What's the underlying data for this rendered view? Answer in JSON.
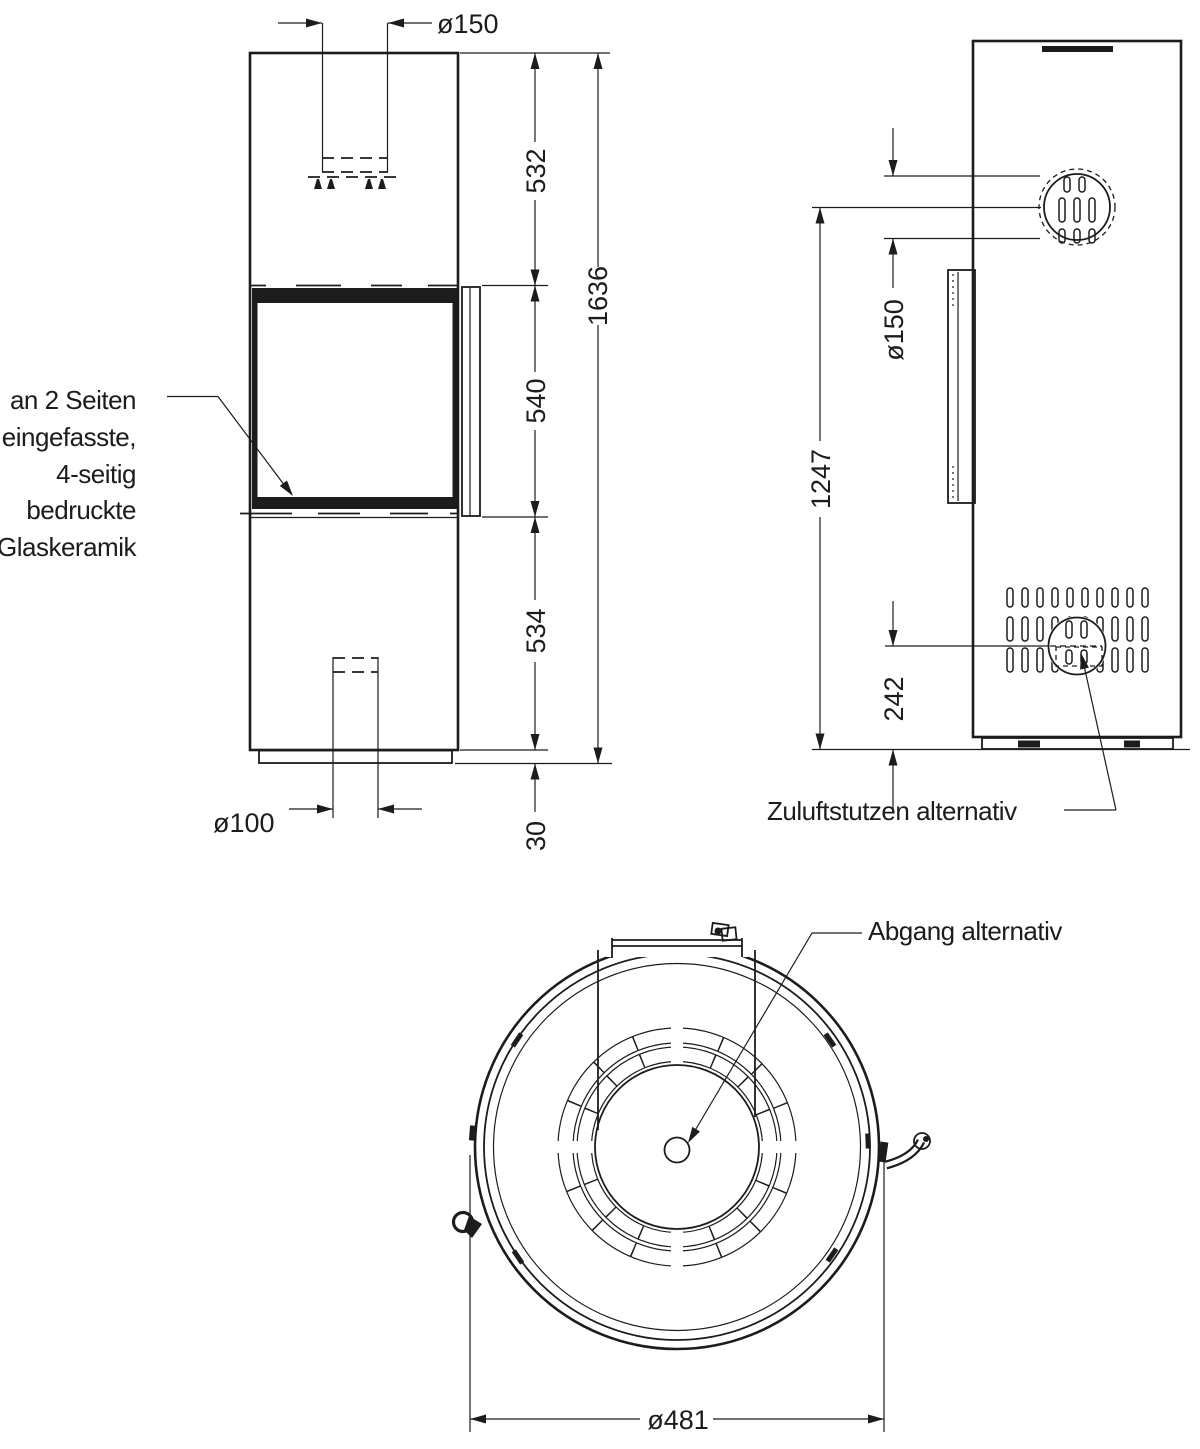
{
  "annotations": {
    "glass_note": {
      "lines": [
        "an 2 Seiten",
        "eingefasste,",
        "4-seitig",
        "bedruckte",
        "Glaskeramik"
      ]
    },
    "air_inlet_label": "Zuluftstutzen alternativ",
    "flue_outlet_label": "Abgang alternativ"
  },
  "dimensions": {
    "front_view": {
      "flue_diameter_top": "ø150",
      "upper_section_height": "532",
      "glass_section_height": "540",
      "lower_section_height": "534",
      "plinth_height": "30",
      "total_height": "1636",
      "air_inlet_diameter_bottom": "ø100"
    },
    "side_view": {
      "flue_diameter_rear": "ø150",
      "flue_center_height": "1247",
      "air_inlet_center_height": "242"
    },
    "top_view": {
      "outer_diameter": "ø481"
    }
  },
  "colors": {
    "ink": "#1c1c1c",
    "background": "#ffffff"
  }
}
